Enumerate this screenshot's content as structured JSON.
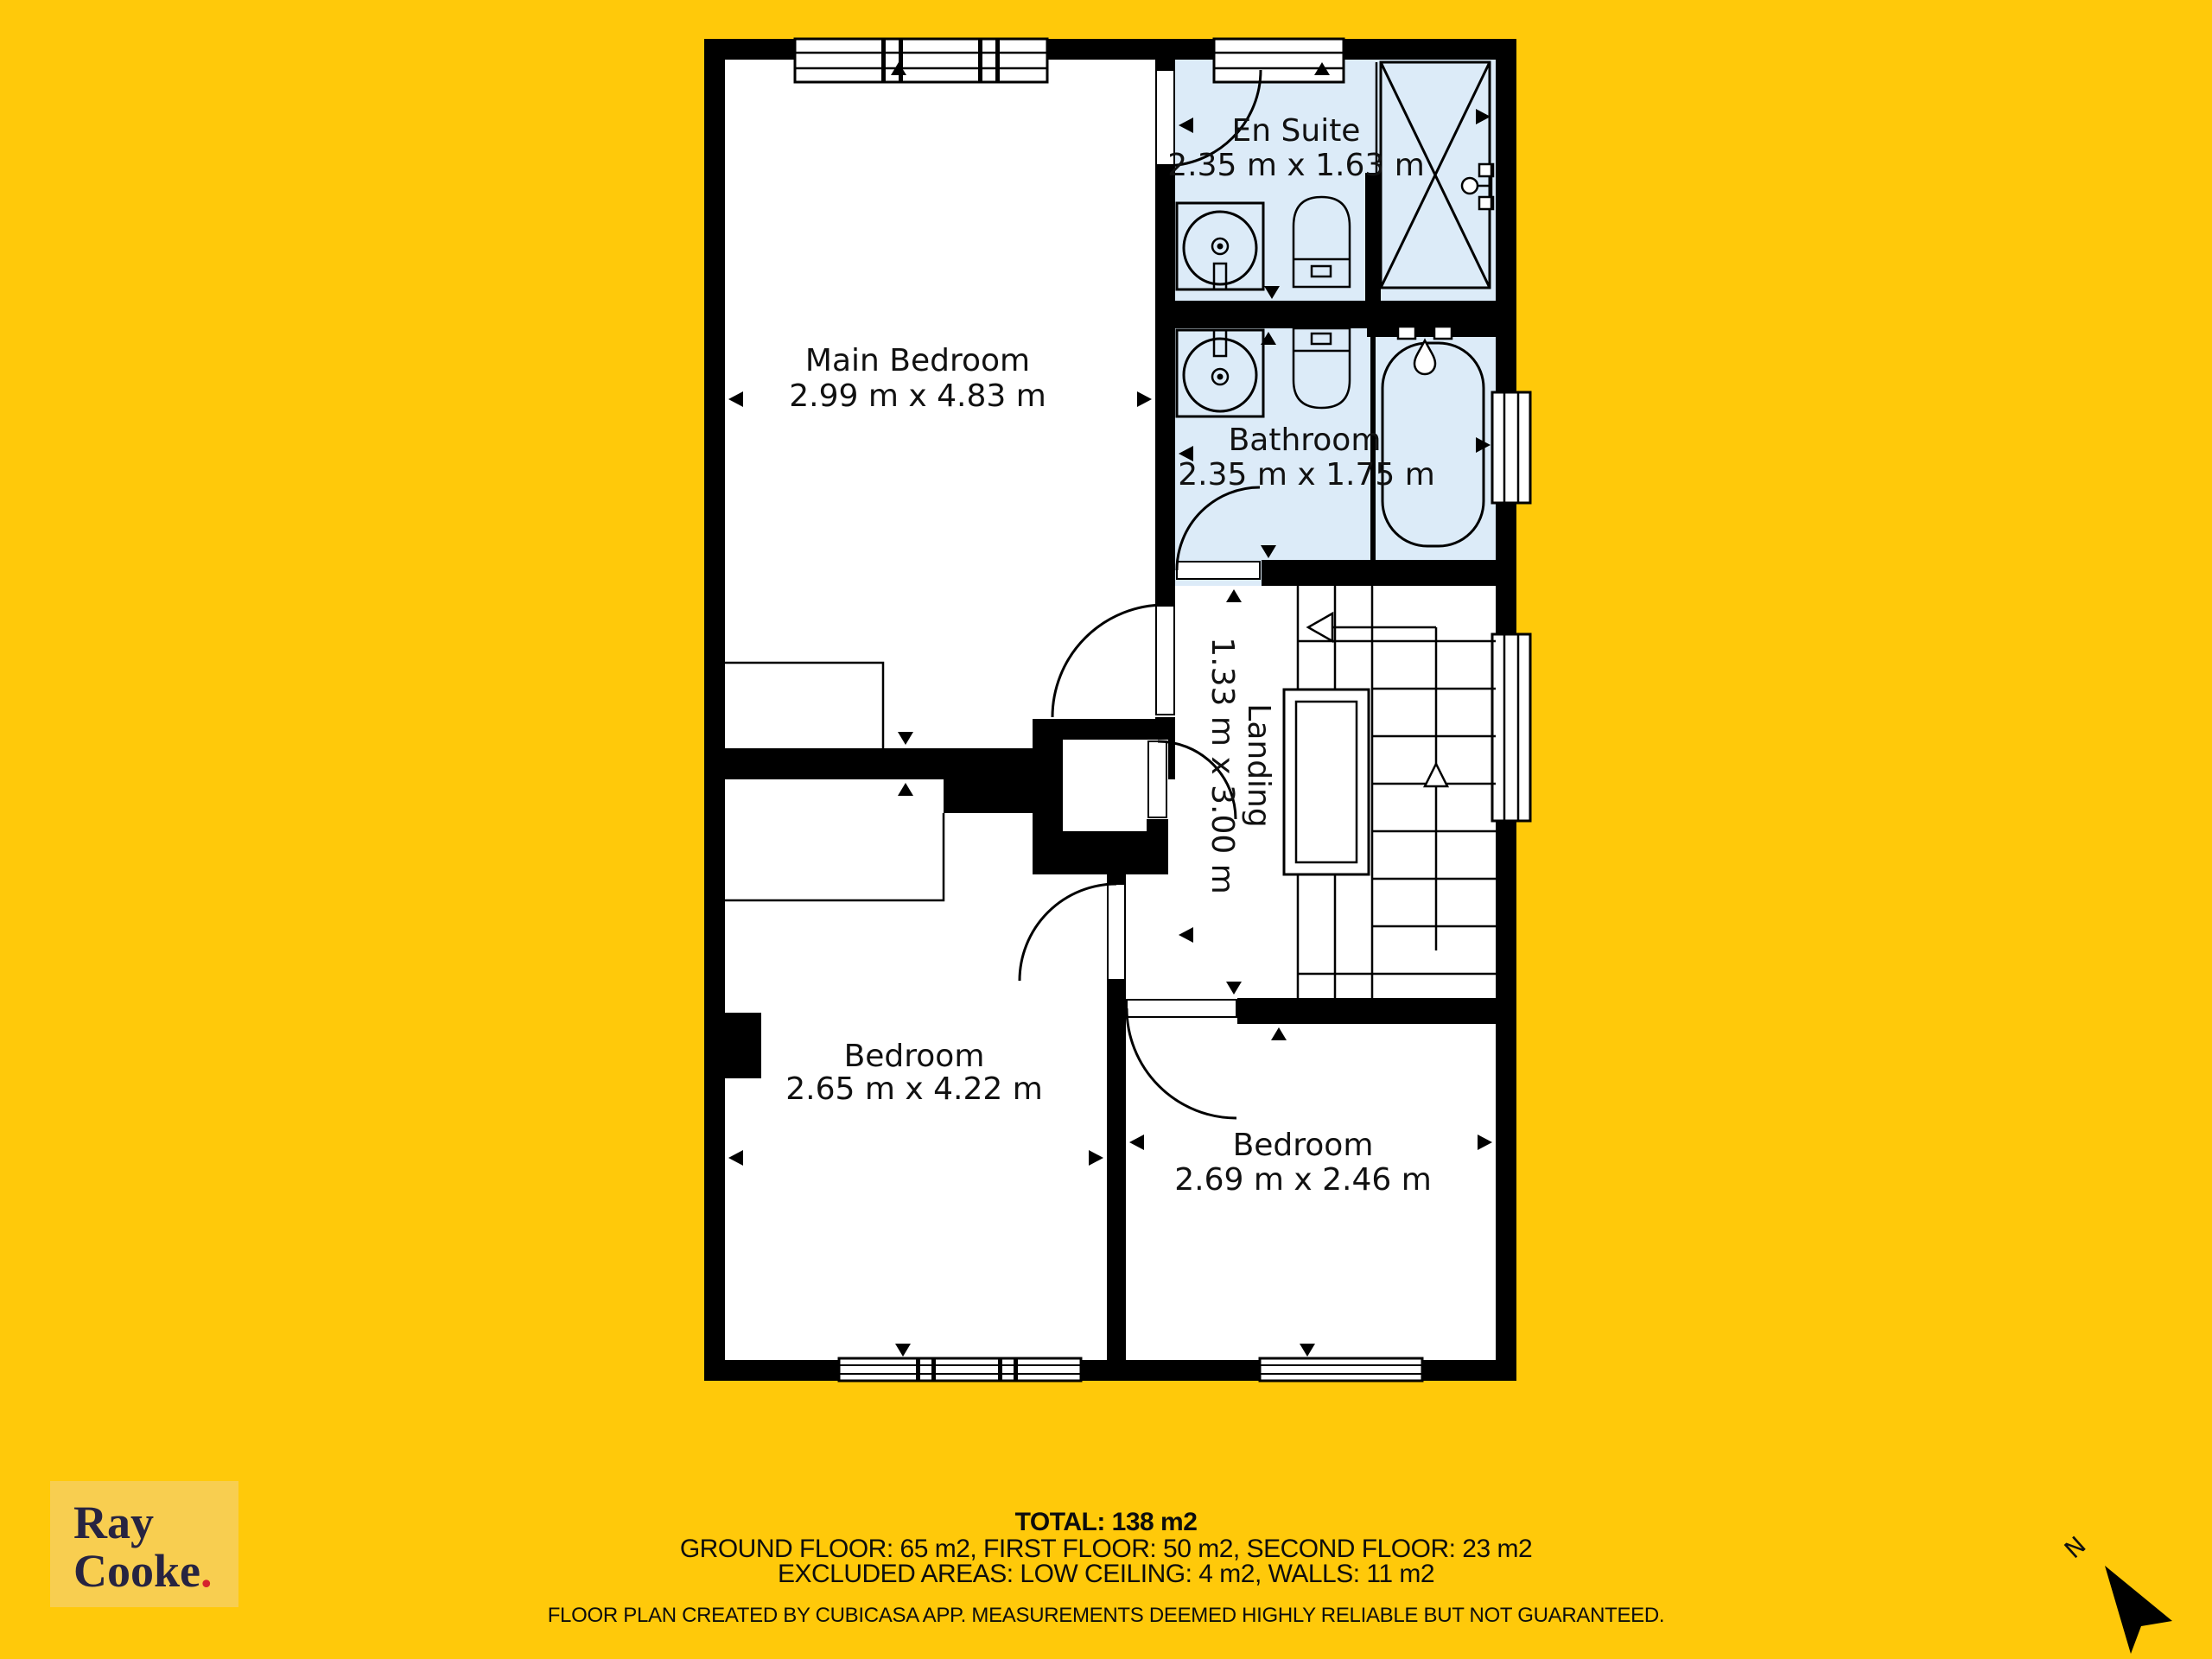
{
  "plan": {
    "rooms": {
      "main_bedroom": {
        "name": "Main Bedroom",
        "dims": "2.99 m x 4.83 m"
      },
      "en_suite": {
        "name": "En Suite",
        "dims": "2.35 m x 1.63 m"
      },
      "bathroom": {
        "name": "Bathroom",
        "dims": "2.35 m x 1.75 m"
      },
      "landing": {
        "name": "Landing",
        "dims": "1.33 m x 3.00 m"
      },
      "bedroom_left": {
        "name": "Bedroom",
        "dims": "2.65 m x 4.22 m"
      },
      "bedroom_right": {
        "name": "Bedroom",
        "dims": "2.69 m x 2.46 m"
      }
    },
    "compass": {
      "label": "N"
    }
  },
  "summary": {
    "total": "TOTAL: 138 m2",
    "floors": "GROUND FLOOR: 65 m2, FIRST FLOOR: 50 m2, SECOND FLOOR: 23 m2",
    "excluded": "EXCLUDED AREAS: LOW CEILING: 4 m2, WALLS: 11 m2",
    "disclaimer": "FLOOR PLAN CREATED BY CUBICASA APP. MEASUREMENTS DEEMED HIGHLY RELIABLE BUT NOT GUARANTEED."
  },
  "logo": {
    "line1": "Ray",
    "line2": "Cooke",
    "dot": "."
  },
  "colors": {
    "background": "#FFC90A",
    "wet_room_floor": "#DCEBF8",
    "dry_room_floor": "#FFFFFF",
    "walls": "#000000",
    "logo_background": "#F8CE50",
    "logo_text": "#272441",
    "logo_dot": "#D5232D"
  }
}
